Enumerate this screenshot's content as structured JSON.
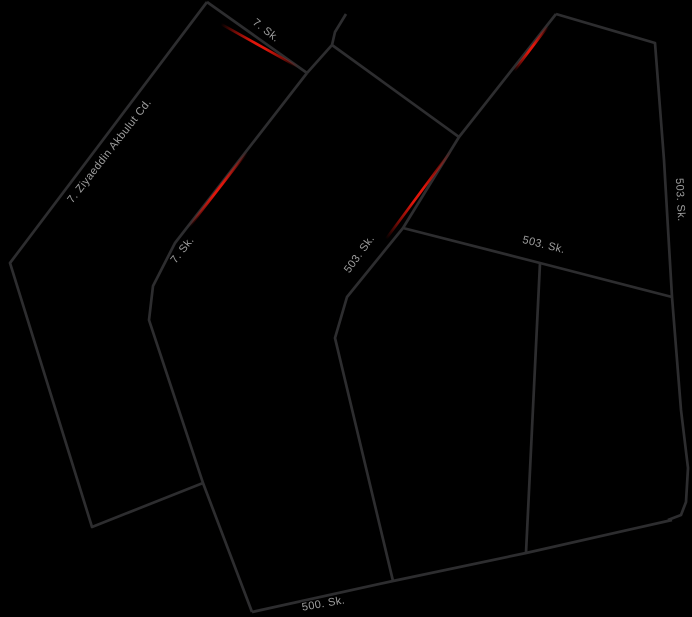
{
  "canvas": {
    "width": 692,
    "height": 617,
    "background": "#000000"
  },
  "map": {
    "style": "dark-night-mode-road-map",
    "road_color": "#2d2d2f",
    "road_width": 2.7,
    "traffic_jam_color": "#e0160b",
    "label_color": "#9e9e9e",
    "roads": [
      {
        "id": "ziyaeddin-akbulut-cd",
        "points": [
          [
            207,
            2
          ],
          [
            10,
            263
          ],
          [
            92,
            527
          ],
          [
            203,
            483
          ]
        ]
      },
      {
        "id": "7-sk-top",
        "points": [
          [
            207,
            2
          ],
          [
            307,
            73
          ]
        ]
      },
      {
        "id": "top-stub",
        "points": [
          [
            346,
            14
          ],
          [
            335,
            32
          ],
          [
            332,
            45
          ],
          [
            307,
            73
          ]
        ]
      },
      {
        "id": "connector-ne",
        "points": [
          [
            332,
            45
          ],
          [
            459,
            137
          ]
        ]
      },
      {
        "id": "7-sk-main",
        "points": [
          [
            307,
            73
          ],
          [
            175,
            243
          ],
          [
            153,
            286
          ],
          [
            149,
            320
          ],
          [
            203,
            483
          ],
          [
            252,
            612
          ]
        ]
      },
      {
        "id": "503-sk-diagonal",
        "points": [
          [
            556,
            14
          ],
          [
            459,
            137
          ],
          [
            403,
            228
          ],
          [
            377,
            260
          ],
          [
            347,
            297
          ],
          [
            335,
            338
          ],
          [
            393,
            581
          ]
        ]
      },
      {
        "id": "503-sk-east",
        "points": [
          [
            556,
            14
          ],
          [
            655,
            43
          ],
          [
            664,
            160
          ],
          [
            672,
            297
          ],
          [
            681,
            410
          ],
          [
            688,
            468
          ],
          [
            686,
            502
          ],
          [
            681,
            515
          ],
          [
            668,
            520
          ]
        ]
      },
      {
        "id": "503-sk-cross",
        "points": [
          [
            403,
            228
          ],
          [
            540,
            263
          ],
          [
            672,
            297
          ]
        ]
      },
      {
        "id": "mid-branch",
        "points": [
          [
            540,
            263
          ],
          [
            526,
            553
          ]
        ]
      },
      {
        "id": "500-sk",
        "points": [
          [
            252,
            612
          ],
          [
            393,
            581
          ],
          [
            526,
            553
          ],
          [
            672,
            520
          ]
        ]
      }
    ],
    "traffic_segments": [
      {
        "id": "jam-7-sk-top",
        "from": [
          221,
          24
        ],
        "to": [
          298,
          67
        ]
      },
      {
        "id": "jam-7-sk-main",
        "from": [
          247,
          152
        ],
        "to": [
          189,
          227
        ]
      },
      {
        "id": "jam-503-upper",
        "from": [
          548,
          26
        ],
        "to": [
          514,
          71
        ]
      },
      {
        "id": "jam-503-lower",
        "from": [
          451,
          151
        ],
        "to": [
          386,
          239
        ]
      }
    ],
    "labels": [
      {
        "id": "label-7-sk-top",
        "text": "7. Sk.",
        "x": 264,
        "y": 33,
        "rotation": 38
      },
      {
        "id": "label-ziyaeddin",
        "text": "7. Ziyaeddin Akbulut Cd.",
        "x": 112,
        "y": 153,
        "rotation": -52
      },
      {
        "id": "label-7-sk-main",
        "text": "7. Sk.",
        "x": 185,
        "y": 252,
        "rotation": -52
      },
      {
        "id": "label-503-sk-diag",
        "text": "503. Sk.",
        "x": 362,
        "y": 256,
        "rotation": -54
      },
      {
        "id": "label-503-sk-cross",
        "text": "503. Sk.",
        "x": 543,
        "y": 248,
        "rotation": 14
      },
      {
        "id": "label-503-sk-east",
        "text": "503. Sk.",
        "x": 677,
        "y": 200,
        "rotation": 87
      },
      {
        "id": "label-500-sk",
        "text": "500. Sk.",
        "x": 324,
        "y": 607,
        "rotation": -10
      }
    ]
  }
}
